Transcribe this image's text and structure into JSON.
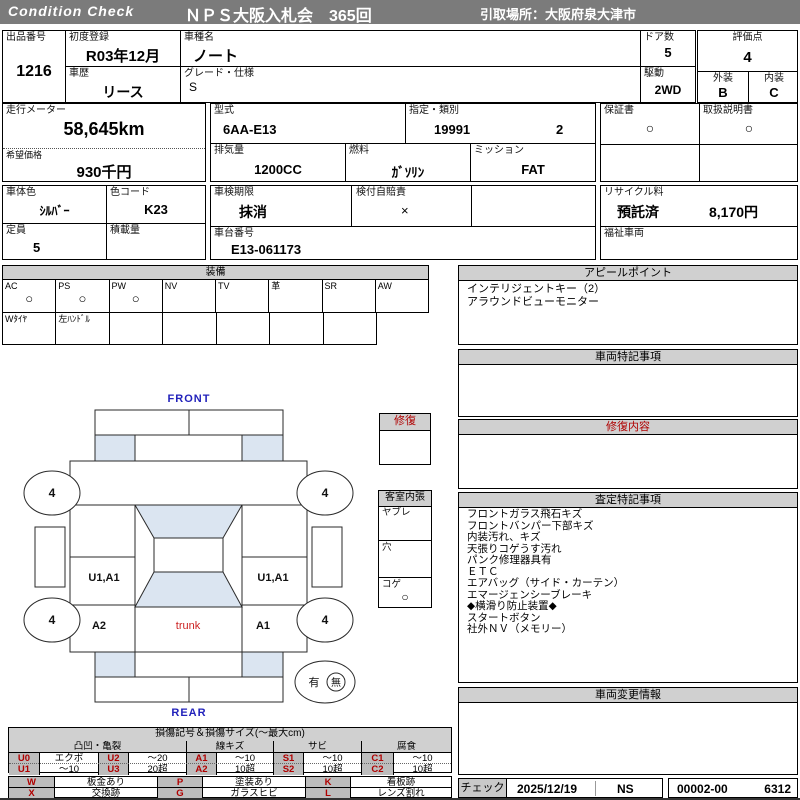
{
  "header": {
    "brand": "Condition  Check",
    "title": "ＮＰＳ大阪入札会　365回",
    "pickup": "引取場所：大阪府泉大津市"
  },
  "info": {
    "lot": {
      "label": "出品番号",
      "value": "1216"
    },
    "first_reg": {
      "label": "初度登録",
      "value": "R03年12月"
    },
    "history": {
      "label": "車歴",
      "value": "リース"
    },
    "model": {
      "label": "車種名",
      "value": "ノート"
    },
    "grade": {
      "label": "グレード・仕様",
      "value": "S"
    },
    "doors": {
      "label": "ドア数",
      "value": "5"
    },
    "drive": {
      "label": "駆動",
      "value": "2WD"
    },
    "score": {
      "label": "評価点",
      "value": "4"
    },
    "exterior": {
      "label": "外装",
      "value": "B"
    },
    "interior": {
      "label": "内装",
      "value": "C"
    },
    "odometer": {
      "label": "走行メーター",
      "value": "58,645km"
    },
    "price": {
      "label": "希望価格",
      "value": "930千円"
    },
    "model_code": {
      "label": "型式",
      "value": "6AA-E13"
    },
    "class": {
      "label": "指定・類別",
      "value1": "19991",
      "value2": "2"
    },
    "displacement": {
      "label": "排気量",
      "value": "1200CC"
    },
    "fuel": {
      "label": "燃料",
      "value": "ｶﾞｿﾘﾝ"
    },
    "transmission": {
      "label": "ミッション",
      "value": "FAT"
    },
    "warranty": {
      "label": "保証書",
      "value": "○"
    },
    "manual": {
      "label": "取扱説明書",
      "value": "○"
    },
    "body_color": {
      "label": "車体色",
      "value": "ｼﾙﾊﾞｰ"
    },
    "color_code": {
      "label": "色コード",
      "value": "K23"
    },
    "capacity": {
      "label": "定員",
      "value": "5"
    },
    "payload": {
      "label": "積載量",
      "value": ""
    },
    "inspection": {
      "label": "車検期限",
      "value": "抹消"
    },
    "insurance": {
      "label": "検付自賠責",
      "value": "×"
    },
    "vin": {
      "label": "車台番号",
      "value": "E13-061173"
    },
    "recycle": {
      "label": "リサイクル料",
      "status": "預託済",
      "fee": "8,170円"
    },
    "welfare": {
      "label": "福祉車両",
      "value": ""
    }
  },
  "equipment": {
    "title": "装備",
    "items": [
      {
        "label": "AC",
        "mark": "○"
      },
      {
        "label": "PS",
        "mark": "○"
      },
      {
        "label": "PW",
        "mark": "○"
      },
      {
        "label": "NV",
        "mark": ""
      },
      {
        "label": "TV",
        "mark": ""
      },
      {
        "label": "革",
        "mark": ""
      },
      {
        "label": "SR",
        "mark": ""
      },
      {
        "label": "AW",
        "mark": ""
      }
    ],
    "extras": [
      "Wﾀｲﾔ",
      "左ﾊﾝﾄﾞﾙ",
      "",
      "",
      "",
      "",
      ""
    ]
  },
  "appeal": {
    "title": "アピールポイント",
    "lines": [
      "インテリジェントキー（2）",
      "アラウンドビューモニター"
    ]
  },
  "vehicle_notes": {
    "title": "車両特記事項"
  },
  "repair_info": {
    "title": "修復内容"
  },
  "assessment": {
    "title": "査定特記事項",
    "lines": [
      "フロントガラス飛石キズ",
      "フロントバンパー下部キズ",
      "内装汚れ、キズ",
      "天張りコゲうす汚れ",
      "パンク修理器具有",
      "ＥＴＣ",
      "エアバッグ（サイド・カーテン）",
      "エマージェンシーブレーキ",
      "◆横滑り防止装置◆",
      "スタートボタン",
      "社外ＮＶ（メモリー）"
    ]
  },
  "changes": {
    "title": "車両変更情報"
  },
  "check": {
    "label": "チェック",
    "date": "2025/12/19",
    "inspector": "NS",
    "code": "00002-00",
    "number": "6312"
  },
  "diagram": {
    "front": "FRONT",
    "rear": "REAR",
    "trunk": "trunk",
    "tire_front_left": "4",
    "tire_front_right": "4",
    "tire_rear_left": "4",
    "tire_rear_right": "4",
    "left_door": "U1,A1",
    "right_door": "U1,A1",
    "left_quarter": "A2",
    "right_quarter": "A1",
    "spare_yes": "有",
    "spare_no": "無",
    "spare_circled": "無",
    "repair_box": {
      "title": "修復"
    },
    "cabin": {
      "title": "客室内張",
      "rows": [
        {
          "label": "ヤブレ",
          "mark": ""
        },
        {
          "label": "穴",
          "mark": ""
        },
        {
          "label": "コゲ",
          "mark": "○"
        }
      ]
    }
  },
  "legend": {
    "title": "損傷記号＆損傷サイズ(～最大cm)",
    "groups": [
      "凸凹・亀裂",
      "線キズ",
      "サビ",
      "腐食"
    ],
    "row1": [
      {
        "code": "U0",
        "size": "エクボ"
      },
      {
        "code": "U2",
        "size": "～20"
      },
      {
        "code": "A1",
        "size": "～10"
      },
      {
        "code": "S1",
        "size": "～10"
      },
      {
        "code": "C1",
        "size": "～10"
      }
    ],
    "row2": [
      {
        "code": "U1",
        "size": "～10"
      },
      {
        "code": "U3",
        "size": "20超"
      },
      {
        "code": "A2",
        "size": "10超"
      },
      {
        "code": "S2",
        "size": "10超"
      },
      {
        "code": "C2",
        "size": "10超"
      }
    ],
    "marks1": [
      {
        "code": "W",
        "label": "板金あり"
      },
      {
        "code": "P",
        "label": "塗装あり"
      },
      {
        "code": "K",
        "label": "看板跡"
      }
    ],
    "marks2": [
      {
        "code": "X",
        "label": "交換跡"
      },
      {
        "code": "G",
        "label": "ガラスヒビ"
      },
      {
        "code": "L",
        "label": "レンズ割れ"
      }
    ]
  },
  "colors": {
    "bar_gray": "#7b7b7b",
    "section_header_gray": "#d0d0d0",
    "legend_code_gray": "#bdbdbd",
    "accent_red": "#b00000",
    "label_blue": "#2222bb",
    "window_blue": "#dbe5f1"
  }
}
